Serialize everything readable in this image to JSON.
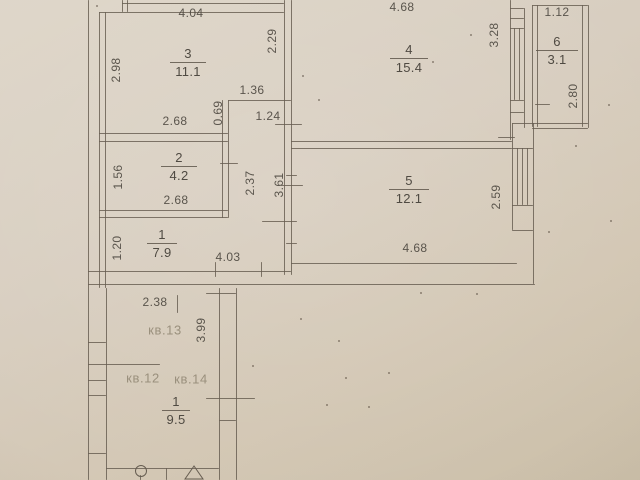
{
  "plan": {
    "colors": {
      "ink": "#665d51",
      "paper": "#d6cbbb",
      "text": "#4f4a42",
      "faint_text": "#9a907d"
    },
    "rooms": [
      {
        "num": "3",
        "area": "11.1",
        "x": 188,
        "y": 47,
        "lw": 36
      },
      {
        "num": "4",
        "area": "15.4",
        "x": 409,
        "y": 43,
        "lw": 38
      },
      {
        "num": "6",
        "area": "3.1",
        "x": 557,
        "y": 35,
        "lw": 42
      },
      {
        "num": "2",
        "area": "4.2",
        "x": 179,
        "y": 151,
        "lw": 36
      },
      {
        "num": "1",
        "area": "7.9",
        "x": 162,
        "y": 228,
        "lw": 30
      },
      {
        "num": "5",
        "area": "12.1",
        "x": 409,
        "y": 174,
        "lw": 40
      },
      {
        "num": "1",
        "area": "9.5",
        "x": 176,
        "y": 395,
        "lw": 28
      }
    ],
    "dimensions": [
      {
        "t": "4.04",
        "x": 191,
        "y": 13,
        "v": false
      },
      {
        "t": "4.68",
        "x": 402,
        "y": 7,
        "v": false
      },
      {
        "t": "1.12",
        "x": 557,
        "y": 12,
        "v": false
      },
      {
        "t": "2.68",
        "x": 175,
        "y": 121,
        "v": false
      },
      {
        "t": "1.36",
        "x": 252,
        "y": 90,
        "v": false
      },
      {
        "t": "1.24",
        "x": 268,
        "y": 116,
        "v": false
      },
      {
        "t": "2.68",
        "x": 176,
        "y": 200,
        "v": false
      },
      {
        "t": "4.03",
        "x": 228,
        "y": 257,
        "v": false
      },
      {
        "t": "4.68",
        "x": 415,
        "y": 248,
        "v": false
      },
      {
        "t": "2.38",
        "x": 155,
        "y": 302,
        "v": false
      },
      {
        "t": "2.98",
        "x": 116,
        "y": 70,
        "v": true
      },
      {
        "t": "2.29",
        "x": 272,
        "y": 41,
        "v": true
      },
      {
        "t": "0.69",
        "x": 218,
        "y": 113,
        "v": true
      },
      {
        "t": "3.28",
        "x": 494,
        "y": 35,
        "v": true
      },
      {
        "t": "2.80",
        "x": 573,
        "y": 96,
        "v": true
      },
      {
        "t": "1.56",
        "x": 118,
        "y": 177,
        "v": true
      },
      {
        "t": "2.37",
        "x": 250,
        "y": 183,
        "v": true
      },
      {
        "t": "3.61",
        "x": 279,
        "y": 185,
        "v": true
      },
      {
        "t": "1.20",
        "x": 117,
        "y": 248,
        "v": true
      },
      {
        "t": "2.59",
        "x": 496,
        "y": 197,
        "v": true
      },
      {
        "t": "3.99",
        "x": 201,
        "y": 330,
        "v": true
      }
    ],
    "unit_labels": [
      {
        "t": "кв.13",
        "x": 165,
        "y": 330
      },
      {
        "t": "кв.12",
        "x": 143,
        "y": 378
      },
      {
        "t": "кв.14",
        "x": 191,
        "y": 379
      }
    ],
    "walls": [
      [
        88,
        0,
        1,
        480
      ],
      [
        99,
        12,
        1,
        276
      ],
      [
        105,
        12,
        1,
        276
      ],
      [
        284,
        0,
        1,
        275
      ],
      [
        291,
        0,
        1,
        275
      ],
      [
        222,
        100,
        1,
        118
      ],
      [
        228,
        100,
        1,
        118
      ],
      [
        510,
        0,
        1,
        140
      ],
      [
        514,
        28,
        1,
        72
      ],
      [
        519,
        28,
        1,
        72
      ],
      [
        524,
        8,
        1,
        120
      ],
      [
        532,
        5,
        1,
        122
      ],
      [
        537,
        5,
        1,
        122
      ],
      [
        582,
        5,
        1,
        122
      ],
      [
        588,
        5,
        1,
        123
      ],
      [
        512,
        123,
        1,
        107
      ],
      [
        533,
        123,
        1,
        161
      ],
      [
        517,
        148,
        1,
        57
      ],
      [
        522,
        148,
        1,
        57
      ],
      [
        527,
        148,
        1,
        57
      ],
      [
        219,
        288,
        1,
        192
      ],
      [
        236,
        288,
        1,
        192
      ],
      [
        106,
        288,
        1,
        192
      ],
      [
        122,
        0,
        1,
        12
      ],
      [
        127,
        0,
        1,
        12
      ],
      [
        177,
        295,
        1,
        18
      ],
      [
        215,
        262,
        1,
        15
      ],
      [
        261,
        262,
        1,
        15
      ],
      [
        140,
        475,
        1,
        5
      ],
      [
        166,
        468,
        1,
        12
      ],
      [
        122,
        3,
        162,
        1
      ],
      [
        99,
        12,
        185,
        1
      ],
      [
        228,
        100,
        63,
        1
      ],
      [
        99,
        133,
        129,
        1
      ],
      [
        99,
        141,
        129,
        1
      ],
      [
        291,
        141,
        221,
        1
      ],
      [
        291,
        148,
        221,
        1
      ],
      [
        99,
        210,
        129,
        1
      ],
      [
        99,
        217,
        129,
        1
      ],
      [
        291,
        263,
        226,
        1
      ],
      [
        88,
        271,
        203,
        1
      ],
      [
        88,
        284,
        447,
        1
      ],
      [
        532,
        5,
        56,
        1
      ],
      [
        512,
        123,
        76,
        1
      ],
      [
        532,
        128,
        56,
        1
      ],
      [
        510,
        8,
        14,
        1
      ],
      [
        510,
        18,
        14,
        1
      ],
      [
        510,
        28,
        14,
        1
      ],
      [
        510,
        100,
        14,
        1
      ],
      [
        510,
        112,
        14,
        1
      ],
      [
        512,
        148,
        21,
        1
      ],
      [
        512,
        205,
        21,
        1
      ],
      [
        512,
        230,
        21,
        1
      ],
      [
        88,
        364,
        72,
        1
      ],
      [
        206,
        398,
        49,
        1
      ],
      [
        219,
        420,
        17,
        1
      ],
      [
        106,
        468,
        113,
        1
      ],
      [
        88,
        342,
        18,
        1
      ],
      [
        88,
        380,
        18,
        1
      ],
      [
        88,
        395,
        18,
        1
      ],
      [
        88,
        453,
        18,
        1
      ],
      [
        206,
        293,
        30,
        1
      ],
      [
        262,
        221,
        35,
        1
      ],
      [
        275,
        124,
        27,
        1
      ],
      [
        220,
        163,
        18,
        1
      ],
      [
        281,
        185,
        22,
        1
      ],
      [
        535,
        104,
        15,
        1
      ],
      [
        498,
        137,
        17,
        1
      ],
      [
        286,
        175,
        11,
        1
      ],
      [
        286,
        243,
        11,
        1
      ]
    ],
    "fixtures": {
      "circle": {
        "x": 140,
        "y": 470,
        "r": 5
      },
      "triangle": {
        "apex_x": 194,
        "apex_y": 466,
        "base_y": 479,
        "half_w": 9
      }
    },
    "specks": [
      [
        470,
        34
      ],
      [
        432,
        61
      ],
      [
        96,
        5
      ],
      [
        318,
        99
      ],
      [
        548,
        231
      ],
      [
        575,
        145
      ],
      [
        608,
        104
      ],
      [
        300,
        318
      ],
      [
        345,
        377
      ],
      [
        388,
        372
      ],
      [
        420,
        292
      ],
      [
        476,
        293
      ],
      [
        326,
        404
      ],
      [
        368,
        406
      ],
      [
        252,
        365
      ],
      [
        610,
        220
      ],
      [
        338,
        340
      ],
      [
        302,
        75
      ]
    ]
  }
}
